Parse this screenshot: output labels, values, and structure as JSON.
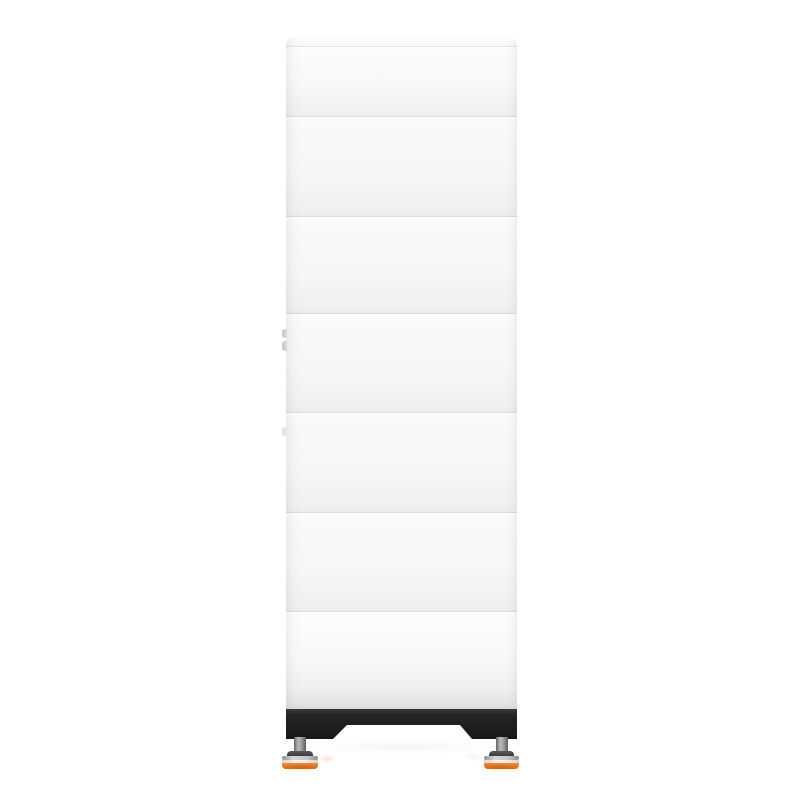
{
  "meta": {
    "type": "product-photo",
    "subject": "white stacked modular battery energy storage tower",
    "view": "front",
    "background_color": "#ffffff",
    "visible_text": ""
  },
  "product": {
    "top_cover": true,
    "stacked_modules_visible": 6,
    "horizontal_seam_lines": 7,
    "left_edge_tabs": 3,
    "base": {
      "color_name": "black",
      "shape": "full-width bar with trapezoid cutout between two legs",
      "adjustable_feet": 2,
      "foot_parts": [
        "gray threaded stem",
        "dark cap ring",
        "silver ring",
        "white ring",
        "orange base ring"
      ]
    }
  },
  "colors": {
    "body": "#f5f5f5",
    "body_highlight": "#fbfbfb",
    "body_shadow": "#eeeeee",
    "edge": "#e2e2e2",
    "seam": "#dcdcdc",
    "base_black": "#232323",
    "foot_stem_gray": "#9a9a9a",
    "foot_silver": "#c6c6c6",
    "foot_white_ring": "#ededed",
    "accent_orange": "#f47b20"
  }
}
